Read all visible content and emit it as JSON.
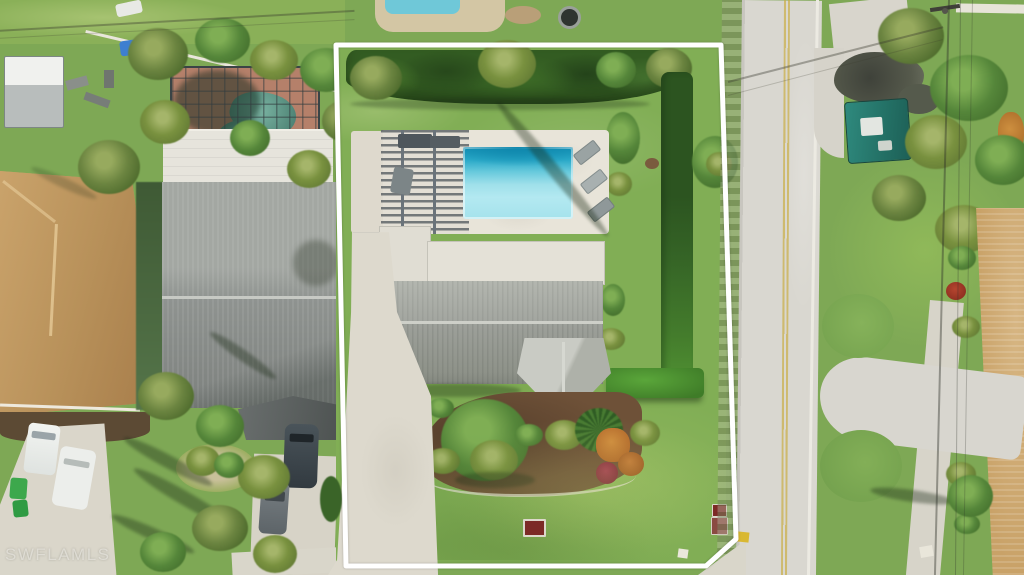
{
  "image": {
    "type": "aerial-drone-photograph",
    "width_px": 1024,
    "height_px": 575,
    "description": "Top-down aerial view of a single-family home lot outlined in white: rectangular swimming pool with pergola sun deck, gray shingle gable roof with white flat lanai roof and hip-roof front porch, mulched landscape bed, open lawns, concrete driveway, privacy hedges; a residential street with double yellow center line runs along the right; neighboring homes, screened pool cage, palm trees, vehicles and overhead power lines surround the lot."
  },
  "watermark": {
    "text": "SWFLAMLS",
    "position": "bottom-left"
  },
  "property_outline": {
    "color": "#ffffff",
    "shape": "rectangle with chamfered bottom-right corner",
    "stroke_px": 5
  },
  "palette": {
    "lawn_green": "#7ea855",
    "bright_lawn": "#8fbb5e",
    "hedge_dark_green": "#2f5a22",
    "hedge_bright_green": "#4f9632",
    "pool_deep_turquoise": "#17a2c2",
    "pool_shallow_aqua": "#a9e6ee",
    "pool_deck": "#e7e3d8",
    "main_roof_gray": "#9a9e98",
    "flat_roof_white": "#e3e0d6",
    "neighbor_roof_tan": "#c09a62",
    "road_concrete": "#d9d7d0",
    "center_line_yellow": "#c9ae45",
    "driveway_concrete": "#ddd9cd",
    "mulch_brown": "#6e5138",
    "asphalt_dark": "#4c4e44",
    "boat_canopy_teal": "#2c8177",
    "utility_box_red": "#7c2a26",
    "screen_cage_deck_terracotta": "#b5806a"
  },
  "scene": {
    "subject_property": {
      "label": "Subject lot outlined in white",
      "backyard": [
        "dark privacy hedge along rear",
        "palm trees overhanging hedge",
        "open back lawn",
        "palm shadow across lawn"
      ],
      "pool_area": [
        "light paver pool deck",
        "rectangular pool with deep end at top",
        "slatted pergola over west half of deck",
        "three lounge chairs on east edge"
      ],
      "house": [
        "L-shaped white flat lanai roof",
        "long gray shingle gable roof with light ridge",
        "hip-roofed entry porch facing front lawn",
        "shaded west walkway"
      ],
      "front_yard": [
        "kidney-shaped mulch bed with shrubs, tree canopy, fan palm and orange/red crotons",
        "concrete curb edging",
        "open front lawn",
        "red utility box in lawn",
        "red mailbox at street edge",
        "small white marker near corner",
        "concrete driveway running to bottom edge"
      ],
      "east_side": [
        "L-shaped bright green hedge",
        "lawn strip along street",
        "small tree at east boundary"
      ]
    },
    "street": {
      "label": "residential street on right side",
      "center_line": "double yellow",
      "grass_swale": "between lot line and pavement",
      "curb_mark": "yellow paint patch near mailbox"
    },
    "west_neighbors": {
      "near": "gray gable-roof house with white flat section, carport awning, dark SUV and gray sedan in drive, palm cluster, round planting bed, long palm shadows",
      "far": "tan hip-roof house with two white vans in driveway and green trash bins",
      "rear": "screened pool enclosure with free-form pool on terracotta deck, metal shed, yard equipment, blue tarp, low white wall"
    },
    "across_street": {
      "items": [
        "concrete driveway slab and apron",
        "dark asphalt patch",
        "boat under teal canopy",
        "dense tropical tree canopy",
        "utility pole with overhead power lines",
        "tan shingle roof house at far right",
        "walkway with croton plantings",
        "driveway flare with rounded lawn corners",
        "palm tree with long shadow",
        "white debris on lawn"
      ]
    },
    "top_strip": {
      "items": [
        "rear neighbor pool corner and sand patch",
        "round fire pit",
        "white pickup at top edge",
        "utility lines crossing"
      ]
    }
  }
}
